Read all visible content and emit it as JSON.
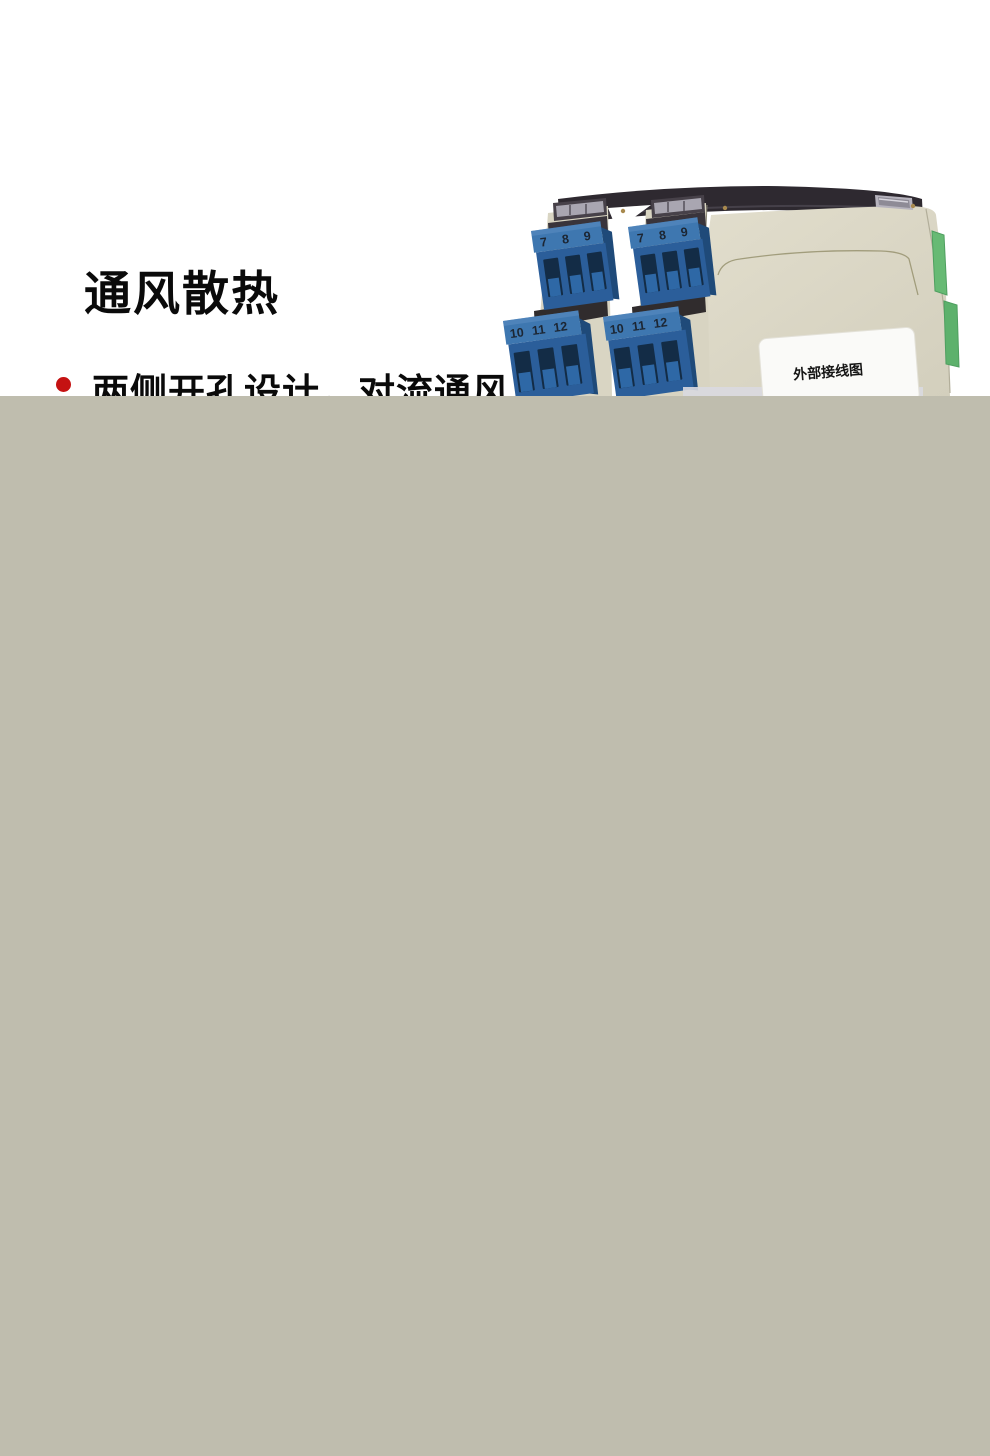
{
  "content": {
    "heading": "通风散热",
    "bullet": {
      "text": "两侧开孔设计，对流通风"
    }
  },
  "product": {
    "wiring_label": "外部接线图",
    "terminals_top": [
      "7",
      "8",
      "9"
    ],
    "terminals_bottom": [
      "10",
      "11",
      "12"
    ]
  },
  "colors": {
    "accent-red": "#c51212",
    "heading-black": "#0a0a0a",
    "overlay-gray": "#bfbdae",
    "body-cream": "#dcd8c6",
    "top-dark": "#2e2930",
    "cap-dark": "#474149",
    "glass-silver": "#a9a6b1",
    "terminal-blue-top": "#3e77b0",
    "terminal-blue-front": "#2b5e9a",
    "terminal-blue-side": "#1f4a79",
    "terminal-recess": "#132c46",
    "connector-green": "#67ba74",
    "label-white": "#fafaf8"
  }
}
